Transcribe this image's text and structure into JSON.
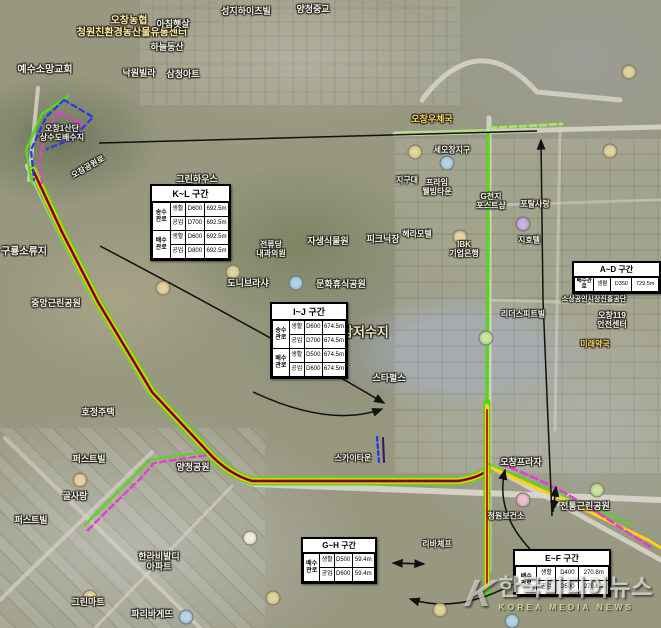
{
  "colors": {
    "pipe_green": "#5ad41e",
    "pipe_yellow": "#ffd400",
    "pipe_red": "#c42020",
    "pipe_purple": "#3a1060",
    "dash_magenta": "#e33fd0",
    "dash_blue": "#2438e8",
    "dash_lightgreen": "#9fe860",
    "road": "#dad8cc",
    "arrow": "#111111",
    "box_bg": "#ffffff"
  },
  "sections": {
    "kl": {
      "title": "K~L 구간",
      "groups": [
        {
          "name": "송수\n관로",
          "rows": [
            [
              "생활",
              "D600",
              "692.5m"
            ],
            [
              "공업",
              "D700",
              "692.5m"
            ]
          ]
        },
        {
          "name": "배수\n관로",
          "rows": [
            [
              "생활",
              "D600",
              "692.5m"
            ],
            [
              "공업",
              "D800",
              "692.5m"
            ]
          ]
        }
      ]
    },
    "ij": {
      "title": "I~J 구간",
      "groups": [
        {
          "name": "송수\n관로",
          "rows": [
            [
              "생활",
              "D600",
              "674.5m"
            ],
            [
              "공업",
              "D700",
              "674.5m"
            ]
          ]
        },
        {
          "name": "배수\n관로",
          "rows": [
            [
              "생활",
              "D500",
              "674.5m"
            ],
            [
              "공업",
              "D600",
              "674.5m"
            ]
          ]
        }
      ]
    },
    "ad": {
      "title": "A~D 구간",
      "groups": [
        {
          "name": "배수관로",
          "rows": [
            [
              "생활",
              "D350",
              "729.5m"
            ]
          ]
        }
      ]
    },
    "gh": {
      "title": "G~H 구간",
      "groups": [
        {
          "name": "배수\n관로",
          "rows": [
            [
              "생활",
              "D500",
              "59.4m"
            ],
            [
              "공업",
              "D600",
              "59.4m"
            ]
          ]
        }
      ]
    },
    "ef": {
      "title": "E~F 구간",
      "groups": [
        {
          "name": "배수\n관로",
          "rows": [
            [
              "생활",
              "D400",
              "270.8m"
            ],
            [
              "공업",
              "D500",
              "270.8m"
            ]
          ]
        }
      ]
    }
  },
  "map": {
    "labels": [
      {
        "text": "오창농협",
        "x": 129,
        "y": 21,
        "size": 10,
        "color": "#ffe9a0"
      },
      {
        "text": "청원친환경농산물유통센터",
        "x": 132,
        "y": 33,
        "size": 10,
        "color": "#ffe9a0"
      },
      {
        "text": "예수소망교회",
        "x": 45,
        "y": 70,
        "size": 10
      },
      {
        "text": "아침햇살",
        "x": 173,
        "y": 24
      },
      {
        "text": "하늘동산",
        "x": 167,
        "y": 47
      },
      {
        "text": "낙원빌라",
        "x": 139,
        "y": 73
      },
      {
        "text": "삼청아트",
        "x": 183,
        "y": 74
      },
      {
        "text": "성지하이츠빌",
        "x": 246,
        "y": 11
      },
      {
        "text": "양청중교",
        "x": 313,
        "y": 9
      },
      {
        "text": "그린하우스",
        "x": 197,
        "y": 179
      },
      {
        "text": "오창1산단\n상수도배수지",
        "x": 62,
        "y": 133,
        "size": 8
      },
      {
        "text": "오창공원로",
        "x": 88,
        "y": 167,
        "size": 8,
        "rot": -30
      },
      {
        "text": "오창우체국",
        "x": 432,
        "y": 119,
        "color": "#ffd95e"
      },
      {
        "text": "세오창지구",
        "x": 452,
        "y": 150,
        "size": 8
      },
      {
        "text": "지구대",
        "x": 407,
        "y": 180,
        "size": 8
      },
      {
        "text": "프라임\n웰빙타운",
        "x": 437,
        "y": 187,
        "size": 8
      },
      {
        "text": "G천지\n포스트샵",
        "x": 491,
        "y": 201,
        "size": 8
      },
      {
        "text": "포탈사랑",
        "x": 535,
        "y": 204,
        "size": 8
      },
      {
        "text": "헤라모텔",
        "x": 417,
        "y": 234,
        "size": 8
      },
      {
        "text": "IBK\n기업은행",
        "x": 464,
        "y": 249,
        "size": 8
      },
      {
        "text": "지호텔",
        "x": 529,
        "y": 240,
        "size": 8
      },
      {
        "text": "전류당\n내과의원",
        "x": 271,
        "y": 249,
        "size": 8
      },
      {
        "text": "자생식물원",
        "x": 328,
        "y": 241
      },
      {
        "text": "피크닉장",
        "x": 383,
        "y": 239
      },
      {
        "text": "문화휴식공원",
        "x": 341,
        "y": 284
      },
      {
        "text": "도니브라샤",
        "x": 248,
        "y": 283
      },
      {
        "text": "호암저수지",
        "x": 359,
        "y": 333,
        "size": 13,
        "color": "#efe6c2"
      },
      {
        "text": "스타펄스",
        "x": 389,
        "y": 378
      },
      {
        "text": "중앙근린공원",
        "x": 56,
        "y": 303
      },
      {
        "text": "구룡소류지",
        "x": 24,
        "y": 252,
        "size": 10
      },
      {
        "text": "호정주택",
        "x": 98,
        "y": 412
      },
      {
        "text": "양청공원",
        "x": 193,
        "y": 467
      },
      {
        "text": "스카이타운",
        "x": 353,
        "y": 458,
        "size": 8
      },
      {
        "text": "오창프라자",
        "x": 521,
        "y": 462
      },
      {
        "text": "오창119\n안전센터",
        "x": 612,
        "y": 320,
        "size": 8
      },
      {
        "text": "미래약국",
        "x": 595,
        "y": 344,
        "size": 8,
        "color": "#ffd95e"
      },
      {
        "text": "소상공인시장진흥공단",
        "x": 594,
        "y": 300,
        "size": 7
      },
      {
        "text": "리더스피트빌",
        "x": 523,
        "y": 314,
        "size": 8
      },
      {
        "text": "퍼스트빌",
        "x": 89,
        "y": 459
      },
      {
        "text": "퍼스트빌",
        "x": 31,
        "y": 520
      },
      {
        "text": "골사랑",
        "x": 75,
        "y": 496
      },
      {
        "text": "그린마트",
        "x": 88,
        "y": 602
      },
      {
        "text": "한라비발디\n아파트",
        "x": 159,
        "y": 562
      },
      {
        "text": "파리바게뜨",
        "x": 152,
        "y": 614
      },
      {
        "text": "전통근린공원",
        "x": 585,
        "y": 506
      },
      {
        "text": "청원보건소",
        "x": 506,
        "y": 516,
        "size": 8
      },
      {
        "text": "리바체프",
        "x": 437,
        "y": 544,
        "size": 8
      }
    ],
    "dots": [
      {
        "x": 233,
        "y": 272,
        "c": "#ead9a0"
      },
      {
        "x": 163,
        "y": 288,
        "c": "#ead9a0"
      },
      {
        "x": 296,
        "y": 283,
        "c": "#b5daf0"
      },
      {
        "x": 447,
        "y": 163,
        "c": "#b5daf0"
      },
      {
        "x": 415,
        "y": 152,
        "c": "#ead9a0"
      },
      {
        "x": 460,
        "y": 237,
        "c": "#ead9a0"
      },
      {
        "x": 523,
        "y": 224,
        "c": "#cfb2e8"
      },
      {
        "x": 486,
        "y": 338,
        "c": "#cdeba6"
      },
      {
        "x": 318,
        "y": 572,
        "c": "#cdeba6"
      },
      {
        "x": 80,
        "y": 480,
        "c": "#ead9a0"
      },
      {
        "x": 90,
        "y": 597,
        "c": "#ead9a0"
      },
      {
        "x": 250,
        "y": 538,
        "c": "#f7f4ea"
      },
      {
        "x": 523,
        "y": 500,
        "c": "#f3c3d5"
      },
      {
        "x": 597,
        "y": 490,
        "c": "#cdeba6"
      },
      {
        "x": 186,
        "y": 617,
        "c": "#b5daf0"
      },
      {
        "x": 440,
        "y": 610,
        "c": "#ead9a0"
      },
      {
        "x": 512,
        "y": 621,
        "c": "#b5daf0"
      },
      {
        "x": 610,
        "y": 151,
        "c": "#ead9a0"
      },
      {
        "x": 629,
        "y": 72,
        "c": "#ead9a0"
      },
      {
        "x": 273,
        "y": 598,
        "c": "#ead9a0"
      }
    ]
  },
  "watermark": {
    "logo": "K",
    "title": "한국미디어뉴스",
    "subtitle": "KOREA MEDIA NEWS"
  }
}
